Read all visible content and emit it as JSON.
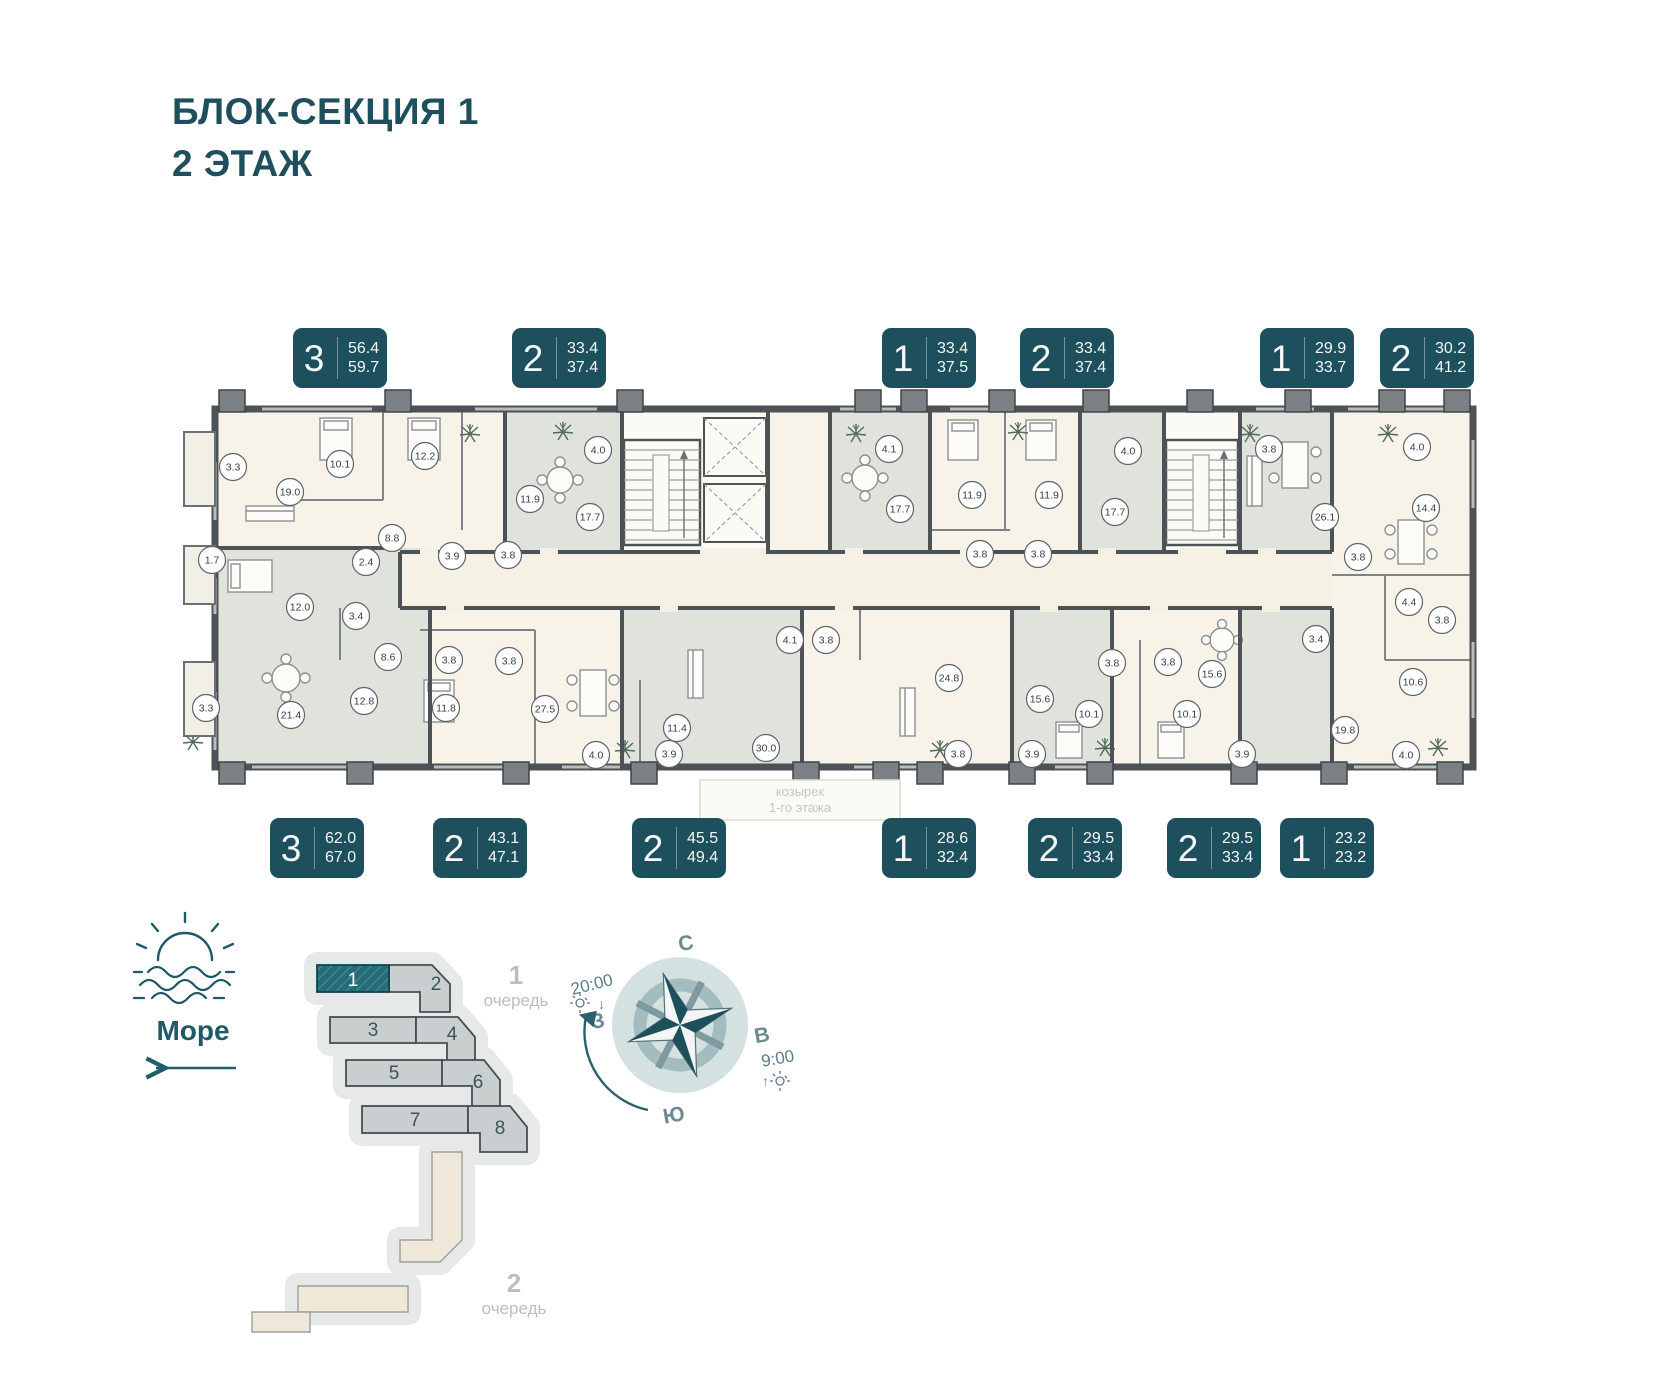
{
  "title": {
    "line1": "БЛОК-СЕКЦИЯ 1",
    "line2": "2 ЭТАЖ"
  },
  "colors": {
    "teal": "#1e4f5c",
    "wall": "#4c5255",
    "cream": "#f7f3e8",
    "sage": "#dfe3dc",
    "corridor": "#f5f1e4",
    "site_gray": "#c9cfcf",
    "site_teal": "#256b78",
    "beige": "#efe8d8"
  },
  "apartments_top": [
    {
      "rooms": "3",
      "area1": "56.4",
      "area2": "59.7",
      "x": 293
    },
    {
      "rooms": "2",
      "area1": "33.4",
      "area2": "37.4",
      "x": 512
    },
    {
      "rooms": "1",
      "area1": "33.4",
      "area2": "37.5",
      "x": 882
    },
    {
      "rooms": "2",
      "area1": "33.4",
      "area2": "37.4",
      "x": 1020
    },
    {
      "rooms": "1",
      "area1": "29.9",
      "area2": "33.7",
      "x": 1260
    },
    {
      "rooms": "2",
      "area1": "30.2",
      "area2": "41.2",
      "x": 1380
    }
  ],
  "apartments_bottom": [
    {
      "rooms": "3",
      "area1": "62.0",
      "area2": "67.0",
      "x": 270
    },
    {
      "rooms": "2",
      "area1": "43.1",
      "area2": "47.1",
      "x": 433
    },
    {
      "rooms": "2",
      "area1": "45.5",
      "area2": "49.4",
      "x": 632
    },
    {
      "rooms": "1",
      "area1": "28.6",
      "area2": "32.4",
      "x": 882
    },
    {
      "rooms": "2",
      "area1": "29.5",
      "area2": "33.4",
      "x": 1028
    },
    {
      "rooms": "2",
      "area1": "29.5",
      "area2": "33.4",
      "x": 1167
    },
    {
      "rooms": "1",
      "area1": "23.2",
      "area2": "23.2",
      "x": 1280
    }
  ],
  "plan": {
    "note_line1": "козырек",
    "note_line2": "1-го этажа",
    "room_labels": [
      {
        "v": "3.3",
        "x": 233,
        "y": 467
      },
      {
        "v": "19.0",
        "x": 290,
        "y": 492
      },
      {
        "v": "10.1",
        "x": 340,
        "y": 464
      },
      {
        "v": "8.8",
        "x": 392,
        "y": 538
      },
      {
        "v": "2.4",
        "x": 366,
        "y": 562
      },
      {
        "v": "12.2",
        "x": 425,
        "y": 456
      },
      {
        "v": "11.9",
        "x": 530,
        "y": 499
      },
      {
        "v": "3.9",
        "x": 452,
        "y": 556
      },
      {
        "v": "3.8",
        "x": 508,
        "y": 555
      },
      {
        "v": "4.0",
        "x": 598,
        "y": 450
      },
      {
        "v": "17.7",
        "x": 590,
        "y": 517
      },
      {
        "v": "4.1",
        "x": 889,
        "y": 449
      },
      {
        "v": "17.7",
        "x": 900,
        "y": 509
      },
      {
        "v": "11.9",
        "x": 972,
        "y": 495
      },
      {
        "v": "3.8",
        "x": 980,
        "y": 554
      },
      {
        "v": "3.8",
        "x": 1038,
        "y": 554
      },
      {
        "v": "11.9",
        "x": 1049,
        "y": 495
      },
      {
        "v": "4.0",
        "x": 1128,
        "y": 451
      },
      {
        "v": "17.7",
        "x": 1115,
        "y": 512
      },
      {
        "v": "3.8",
        "x": 1269,
        "y": 449
      },
      {
        "v": "26.1",
        "x": 1325,
        "y": 517
      },
      {
        "v": "3.8",
        "x": 1358,
        "y": 557
      },
      {
        "v": "4.0",
        "x": 1417,
        "y": 447
      },
      {
        "v": "14.4",
        "x": 1426,
        "y": 508
      },
      {
        "v": "1.7",
        "x": 212,
        "y": 560
      },
      {
        "v": "12.0",
        "x": 300,
        "y": 607
      },
      {
        "v": "3.4",
        "x": 356,
        "y": 616
      },
      {
        "v": "8.6",
        "x": 388,
        "y": 657
      },
      {
        "v": "3.3",
        "x": 206,
        "y": 708
      },
      {
        "v": "21.4",
        "x": 291,
        "y": 715
      },
      {
        "v": "12.8",
        "x": 364,
        "y": 701
      },
      {
        "v": "3.8",
        "x": 449,
        "y": 660
      },
      {
        "v": "3.8",
        "x": 509,
        "y": 661
      },
      {
        "v": "11.8",
        "x": 446,
        "y": 708
      },
      {
        "v": "27.5",
        "x": 545,
        "y": 709
      },
      {
        "v": "4.0",
        "x": 596,
        "y": 755
      },
      {
        "v": "11.4",
        "x": 677,
        "y": 728
      },
      {
        "v": "3.9",
        "x": 669,
        "y": 754
      },
      {
        "v": "30.0",
        "x": 766,
        "y": 748
      },
      {
        "v": "4.1",
        "x": 790,
        "y": 640
      },
      {
        "v": "3.8",
        "x": 826,
        "y": 640
      },
      {
        "v": "24.8",
        "x": 949,
        "y": 678
      },
      {
        "v": "3.8",
        "x": 958,
        "y": 754
      },
      {
        "v": "3.9",
        "x": 1032,
        "y": 754
      },
      {
        "v": "15.6",
        "x": 1040,
        "y": 699
      },
      {
        "v": "3.8",
        "x": 1112,
        "y": 663
      },
      {
        "v": "3.8",
        "x": 1168,
        "y": 662
      },
      {
        "v": "10.1",
        "x": 1089,
        "y": 714
      },
      {
        "v": "10.1",
        "x": 1187,
        "y": 714
      },
      {
        "v": "15.6",
        "x": 1212,
        "y": 674
      },
      {
        "v": "3.9",
        "x": 1242,
        "y": 754
      },
      {
        "v": "3.4",
        "x": 1316,
        "y": 639
      },
      {
        "v": "19.8",
        "x": 1345,
        "y": 730
      },
      {
        "v": "4.4",
        "x": 1409,
        "y": 602
      },
      {
        "v": "3.8",
        "x": 1442,
        "y": 620
      },
      {
        "v": "10.6",
        "x": 1413,
        "y": 682
      },
      {
        "v": "4.0",
        "x": 1406,
        "y": 755
      }
    ]
  },
  "site_plan": {
    "sea_label": "Море",
    "phase1_num": "1",
    "phase1_word": "очередь",
    "phase2_num": "2",
    "phase2_word": "очередь",
    "buildings": [
      "1",
      "2",
      "3",
      "4",
      "5",
      "6",
      "7",
      "8"
    ],
    "highlighted_building": "1"
  },
  "compass": {
    "n": "С",
    "e": "В",
    "s": "Ю",
    "w": "З",
    "sunset": "20:00",
    "sunrise": "9:00"
  }
}
